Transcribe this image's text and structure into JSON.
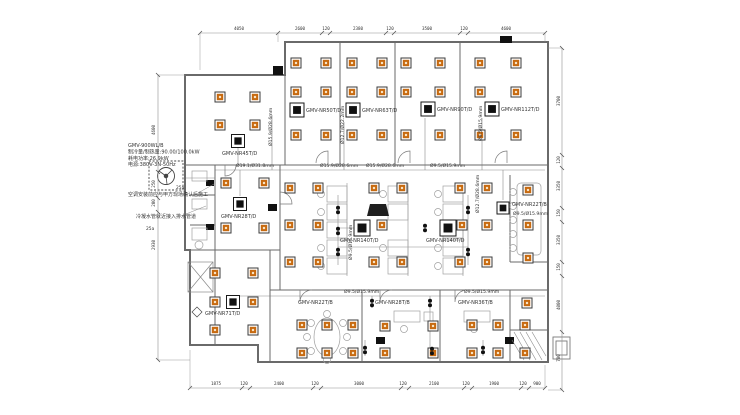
{
  "drawing_title": "VRF air-conditioning floor plan",
  "colors": {
    "diffuser": "#c76a10",
    "diffuser_center": "#f8e3c4",
    "unit_black": "#111111",
    "wall": "#6a6a6a",
    "thin_line": "#8a8a8a",
    "text": "#333333"
  },
  "outdoor_unit": {
    "spec_lines": [
      "GMV-900WL/B",
      "制冷量/制热量:90.00/100.0kW",
      "耗电功率:26.9kW",
      "电源:380V-3N-50Hz"
    ],
    "flow_labels": [
      {
        "t": "25a",
        "x": 176,
        "y": 189
      },
      {
        "t": "25a",
        "x": 146,
        "y": 230
      }
    ]
  },
  "notes": [
    {
      "t": "空调安装前应与甲方现场确认后施工",
      "x": 128,
      "y": 196
    },
    {
      "t": "冷凝水管就近接入排水管道",
      "x": 136,
      "y": 218
    }
  ],
  "indoor_units": [
    {
      "label": "GMV-NR45T/D",
      "x": 238,
      "y": 141,
      "lx": 222,
      "ly": 155,
      "size": 13
    },
    {
      "label": "GMV-NR50T/D",
      "x": 297,
      "y": 110,
      "lx": 306,
      "ly": 112,
      "size": 14
    },
    {
      "label": "GMV-NR63T/D",
      "x": 353,
      "y": 110,
      "lx": 362,
      "ly": 112,
      "size": 14
    },
    {
      "label": "GMV-NR90T/D",
      "x": 428,
      "y": 109,
      "lx": 437,
      "ly": 111,
      "size": 14
    },
    {
      "label": "GMV-NR112T/D",
      "x": 492,
      "y": 109,
      "lx": 501,
      "ly": 111,
      "size": 14
    },
    {
      "label": "GMV-NR28T/D",
      "x": 240,
      "y": 204,
      "lx": 221,
      "ly": 218,
      "size": 13
    },
    {
      "label": "GMV-NR140T/D",
      "x": 362,
      "y": 228,
      "lx": 340,
      "ly": 242,
      "size": 16
    },
    {
      "label": "GMV-NR140T/D",
      "x": 448,
      "y": 228,
      "lx": 426,
      "ly": 242,
      "size": 16
    },
    {
      "label": "GMV-NR22T/B",
      "x": 503,
      "y": 208,
      "lx": 512,
      "ly": 206,
      "size": 12
    },
    {
      "label": "GMV-NR71T/D",
      "x": 233,
      "y": 302,
      "lx": 205,
      "ly": 315,
      "size": 13
    }
  ],
  "unit_labels": [
    {
      "t": "GMV-NR22T/B",
      "x": 298,
      "y": 304
    },
    {
      "t": "GMV-NR28T/B",
      "x": 375,
      "y": 304
    },
    {
      "t": "GMV-NR36T/B",
      "x": 458,
      "y": 304
    }
  ],
  "pipe_labels": [
    {
      "t": "Ø19.1/Ø31.8mm",
      "x": 236,
      "y": 167,
      "rot": 0
    },
    {
      "t": "Ø15.9/Ø28.6mm",
      "x": 320,
      "y": 167,
      "rot": 0
    },
    {
      "t": "Ø15.9/Ø28.6mm",
      "x": 366,
      "y": 167,
      "rot": 0
    },
    {
      "t": "Ø9.5/Ø15.9mm",
      "x": 430,
      "y": 167,
      "rot": 0
    },
    {
      "t": "Ø9.5/Ø15.9mm",
      "x": 344,
      "y": 293,
      "rot": 0
    },
    {
      "t": "Ø9.5/Ø15.9mm",
      "x": 464,
      "y": 293,
      "rot": 0
    },
    {
      "t": "Ø15.9/Ø28.6mm",
      "x": 272,
      "y": 146,
      "rot": -90
    },
    {
      "t": "Ø12.7/Ø22.2mm",
      "x": 344,
      "y": 144,
      "rot": -90
    },
    {
      "t": "Ø9.5/Ø15.9mm",
      "x": 482,
      "y": 141,
      "rot": -90
    },
    {
      "t": "Ø12.7/Ø28.6mm",
      "x": 479,
      "y": 213,
      "rot": -90
    },
    {
      "t": "Ø9.5/Ø15.9mm",
      "x": 352,
      "y": 260,
      "rot": -90
    },
    {
      "t": "Ø9.5/Ø15.9mm",
      "x": 513,
      "y": 215,
      "rot": 0
    }
  ],
  "diffusers": [
    [
      220,
      97
    ],
    [
      255,
      97
    ],
    [
      220,
      125
    ],
    [
      255,
      125
    ],
    [
      296,
      63
    ],
    [
      326,
      63
    ],
    [
      296,
      92
    ],
    [
      326,
      92
    ],
    [
      296,
      135
    ],
    [
      326,
      135
    ],
    [
      352,
      63
    ],
    [
      382,
      63
    ],
    [
      352,
      92
    ],
    [
      382,
      92
    ],
    [
      352,
      135
    ],
    [
      382,
      135
    ],
    [
      406,
      63
    ],
    [
      440,
      63
    ],
    [
      406,
      92
    ],
    [
      440,
      92
    ],
    [
      406,
      135
    ],
    [
      440,
      135
    ],
    [
      480,
      63
    ],
    [
      516,
      63
    ],
    [
      480,
      92
    ],
    [
      516,
      92
    ],
    [
      480,
      135
    ],
    [
      516,
      135
    ],
    [
      226,
      183
    ],
    [
      264,
      183
    ],
    [
      226,
      228
    ],
    [
      264,
      228
    ],
    [
      290,
      188
    ],
    [
      318,
      188
    ],
    [
      374,
      188
    ],
    [
      402,
      188
    ],
    [
      460,
      188
    ],
    [
      487,
      188
    ],
    [
      290,
      225
    ],
    [
      318,
      225
    ],
    [
      382,
      225
    ],
    [
      462,
      225
    ],
    [
      487,
      225
    ],
    [
      290,
      262
    ],
    [
      318,
      262
    ],
    [
      374,
      262
    ],
    [
      402,
      262
    ],
    [
      460,
      262
    ],
    [
      487,
      262
    ],
    [
      528,
      190
    ],
    [
      528,
      225
    ],
    [
      528,
      258
    ],
    [
      527,
      303
    ],
    [
      215,
      273
    ],
    [
      253,
      273
    ],
    [
      215,
      302
    ],
    [
      253,
      302
    ],
    [
      215,
      330
    ],
    [
      253,
      330
    ],
    [
      302,
      325
    ],
    [
      327,
      325
    ],
    [
      353,
      325
    ],
    [
      302,
      353
    ],
    [
      327,
      353
    ],
    [
      353,
      353
    ],
    [
      385,
      326
    ],
    [
      433,
      326
    ],
    [
      385,
      353
    ],
    [
      433,
      353
    ],
    [
      472,
      325
    ],
    [
      498,
      325
    ],
    [
      525,
      325
    ],
    [
      472,
      353
    ],
    [
      498,
      353
    ],
    [
      525,
      353
    ]
  ],
  "branch_valves": [
    [
      338,
      210
    ],
    [
      338,
      231
    ],
    [
      338,
      252
    ],
    [
      425,
      228
    ],
    [
      468,
      210
    ],
    [
      468,
      252
    ],
    [
      372,
      303
    ],
    [
      430,
      303
    ],
    [
      365,
      350
    ],
    [
      432,
      351
    ],
    [
      483,
      350
    ]
  ],
  "dims": {
    "top": [
      {
        "t": "4050",
        "x": 239
      },
      {
        "t": "2600",
        "x": 300
      },
      {
        "t": "120",
        "x": 326
      },
      {
        "t": "2380",
        "x": 358
      },
      {
        "t": "120",
        "x": 390
      },
      {
        "t": "3500",
        "x": 427
      },
      {
        "t": "120",
        "x": 464
      },
      {
        "t": "4600",
        "x": 506
      }
    ],
    "bottom": [
      {
        "t": "1875",
        "x": 216
      },
      {
        "t": "120",
        "x": 244
      },
      {
        "t": "2400",
        "x": 279
      },
      {
        "t": "120",
        "x": 315
      },
      {
        "t": "3000",
        "x": 359
      },
      {
        "t": "120",
        "x": 403
      },
      {
        "t": "2100",
        "x": 434
      },
      {
        "t": "120",
        "x": 466
      },
      {
        "t": "1900",
        "x": 494
      },
      {
        "t": "120",
        "x": 523
      },
      {
        "t": "900",
        "x": 537
      }
    ],
    "left": [
      {
        "t": "4600",
        "y": 130
      },
      {
        "t": "250",
        "y": 184
      },
      {
        "t": "200",
        "y": 203
      },
      {
        "t": "2930",
        "y": 245
      }
    ],
    "right": [
      {
        "t": "3700",
        "y": 101
      },
      {
        "t": "120",
        "y": 160
      },
      {
        "t": "3350",
        "y": 186
      },
      {
        "t": "150",
        "y": 213
      },
      {
        "t": "3350",
        "y": 240
      },
      {
        "t": "150",
        "y": 267
      },
      {
        "t": "4000",
        "y": 305
      },
      {
        "t": "700",
        "y": 358
      }
    ]
  }
}
